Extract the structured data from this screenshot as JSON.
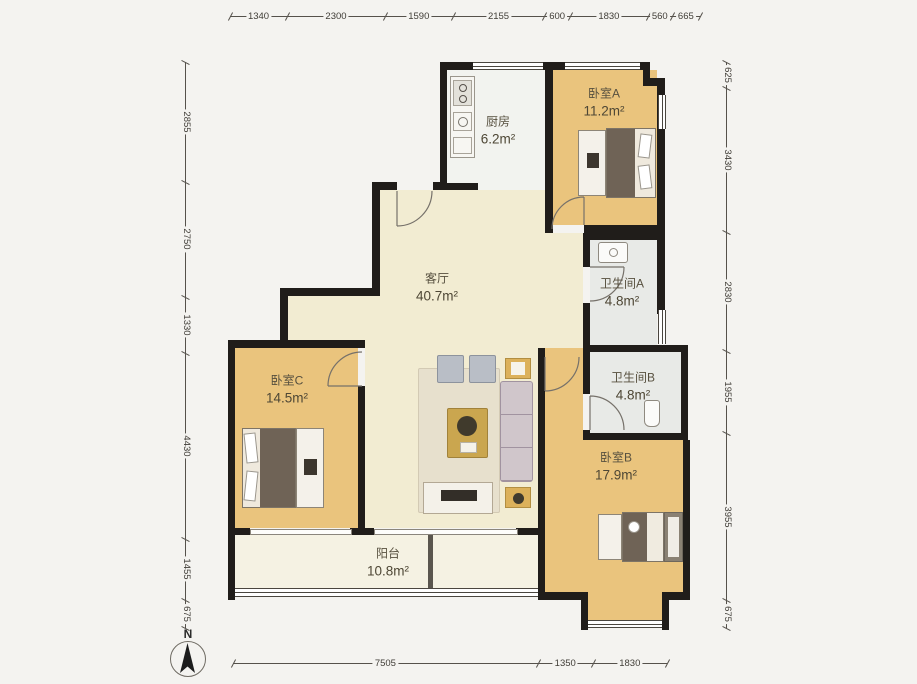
{
  "compass": {
    "label": "N"
  },
  "rooms": {
    "kitchen": {
      "name": "厨房",
      "area": "6.2m²"
    },
    "bedroomA": {
      "name": "卧室A",
      "area": "11.2m²"
    },
    "livingRoom": {
      "name": "客厅",
      "area": "40.7m²"
    },
    "bathroomA": {
      "name": "卫生间A",
      "area": "4.8m²"
    },
    "bathroomB": {
      "name": "卫生间B",
      "area": "4.8m²"
    },
    "bedroomC": {
      "name": "卧室C",
      "area": "14.5m²"
    },
    "bedroomB": {
      "name": "卧室B",
      "area": "17.9m²"
    },
    "balcony": {
      "name": "阳台",
      "area": "10.8m²"
    }
  },
  "dimensions": {
    "top": [
      1340,
      2300,
      1590,
      2155,
      600,
      1830,
      560,
      665
    ],
    "bottom": [
      7505,
      1350,
      1830
    ],
    "left": [
      2855,
      2750,
      1330,
      4430,
      1455,
      675
    ],
    "right": [
      625,
      3430,
      2830,
      1955,
      3955,
      675
    ]
  },
  "colors": {
    "page_bg": "#f4f3f0",
    "wall": "#201d1a",
    "wood": "#eac47d",
    "living": "#f2ecd2",
    "kitchen": "#f2f3ef",
    "bath": "#e8eae7",
    "balcony": "#f5f2e3",
    "accent_gold": "#caa64f",
    "dim_line": "#55514b"
  }
}
